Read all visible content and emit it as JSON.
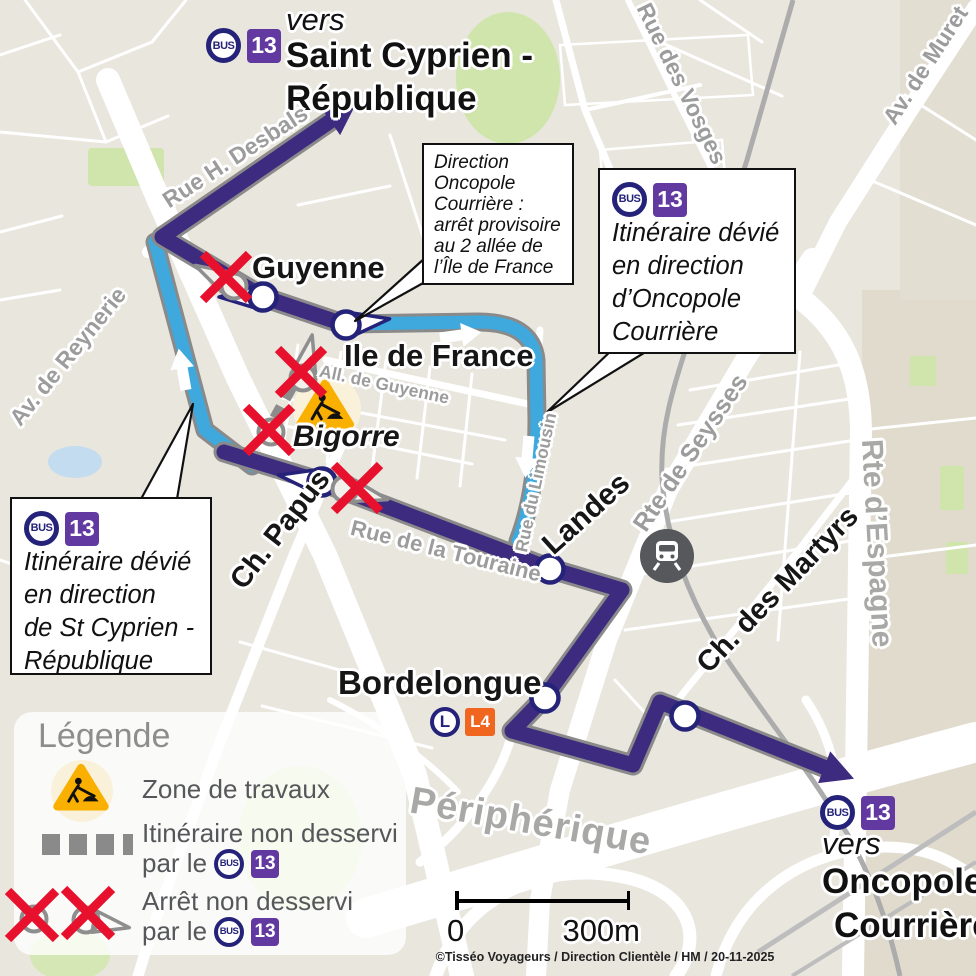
{
  "dest_top": {
    "vers": "vers",
    "line1": "Saint Cyprien -",
    "line2": "République"
  },
  "dest_bottom": {
    "vers": "vers",
    "line1": "Oncopole",
    "line2": "Courrière"
  },
  "badges": {
    "bus": "BUS",
    "line13": "13",
    "lineo": "L",
    "l4": "L4"
  },
  "callout_provisional": {
    "l1": "Direction",
    "l2": "Oncopole",
    "l3": "Courrière :",
    "l4": "arrêt provisoire",
    "l5": "au 2 allée de",
    "l6": "l’Île de France"
  },
  "callout_oncopole": {
    "l1": "Itinéraire dévié",
    "l2": "en direction",
    "l3": "d’Oncopole",
    "l4": "Courrière"
  },
  "callout_stcyprien": {
    "l1": "Itinéraire dévié",
    "l2": "en direction",
    "l3": "de St Cyprien -",
    "l4": "République"
  },
  "stops": {
    "guyenne": "Guyenne",
    "ile_de_france": "Ile de France",
    "bigorre": "Bigorre",
    "landes": "Landes",
    "bordelongue": "Bordelongue"
  },
  "streets": {
    "desbals": "Rue H. Desbals",
    "reynerie": "Av. de Reynerie",
    "vosges": "Rue des Vosges",
    "muret": "Av. de Muret",
    "seysses": "Rte de Seysses",
    "espagne": "Rte d’Espagne",
    "martyrs": "Ch. des Martyrs",
    "papus": "Ch. Papus",
    "touraine": "Rue de la Touraine",
    "all_guyenne": "All. de Guyenne",
    "limousin": "Rue du Limousin",
    "peripherique": "Périphérique"
  },
  "legend": {
    "title": "Légende",
    "zone": "Zone de travaux",
    "itineraire_l1": "Itinéraire non desservi",
    "itineraire_l2": "par le",
    "arret_l1": "Arrêt non desservi",
    "arret_l2": "par le"
  },
  "scale": {
    "zero": "0",
    "distance": "300m"
  },
  "credit": "©Tisséo Voyageurs / Direction Clientèle / HM / 20-11-2025",
  "colors": {
    "route_purple": "#3D2B80",
    "route_blue": "#3FA9DE",
    "badge_navy": "#242379",
    "badge_purple": "#6239A0",
    "l4_orange": "#F0661F",
    "cross_red": "#E8112D",
    "works_yellow": "#F9B000",
    "map_bg": "#E9E6DE"
  }
}
